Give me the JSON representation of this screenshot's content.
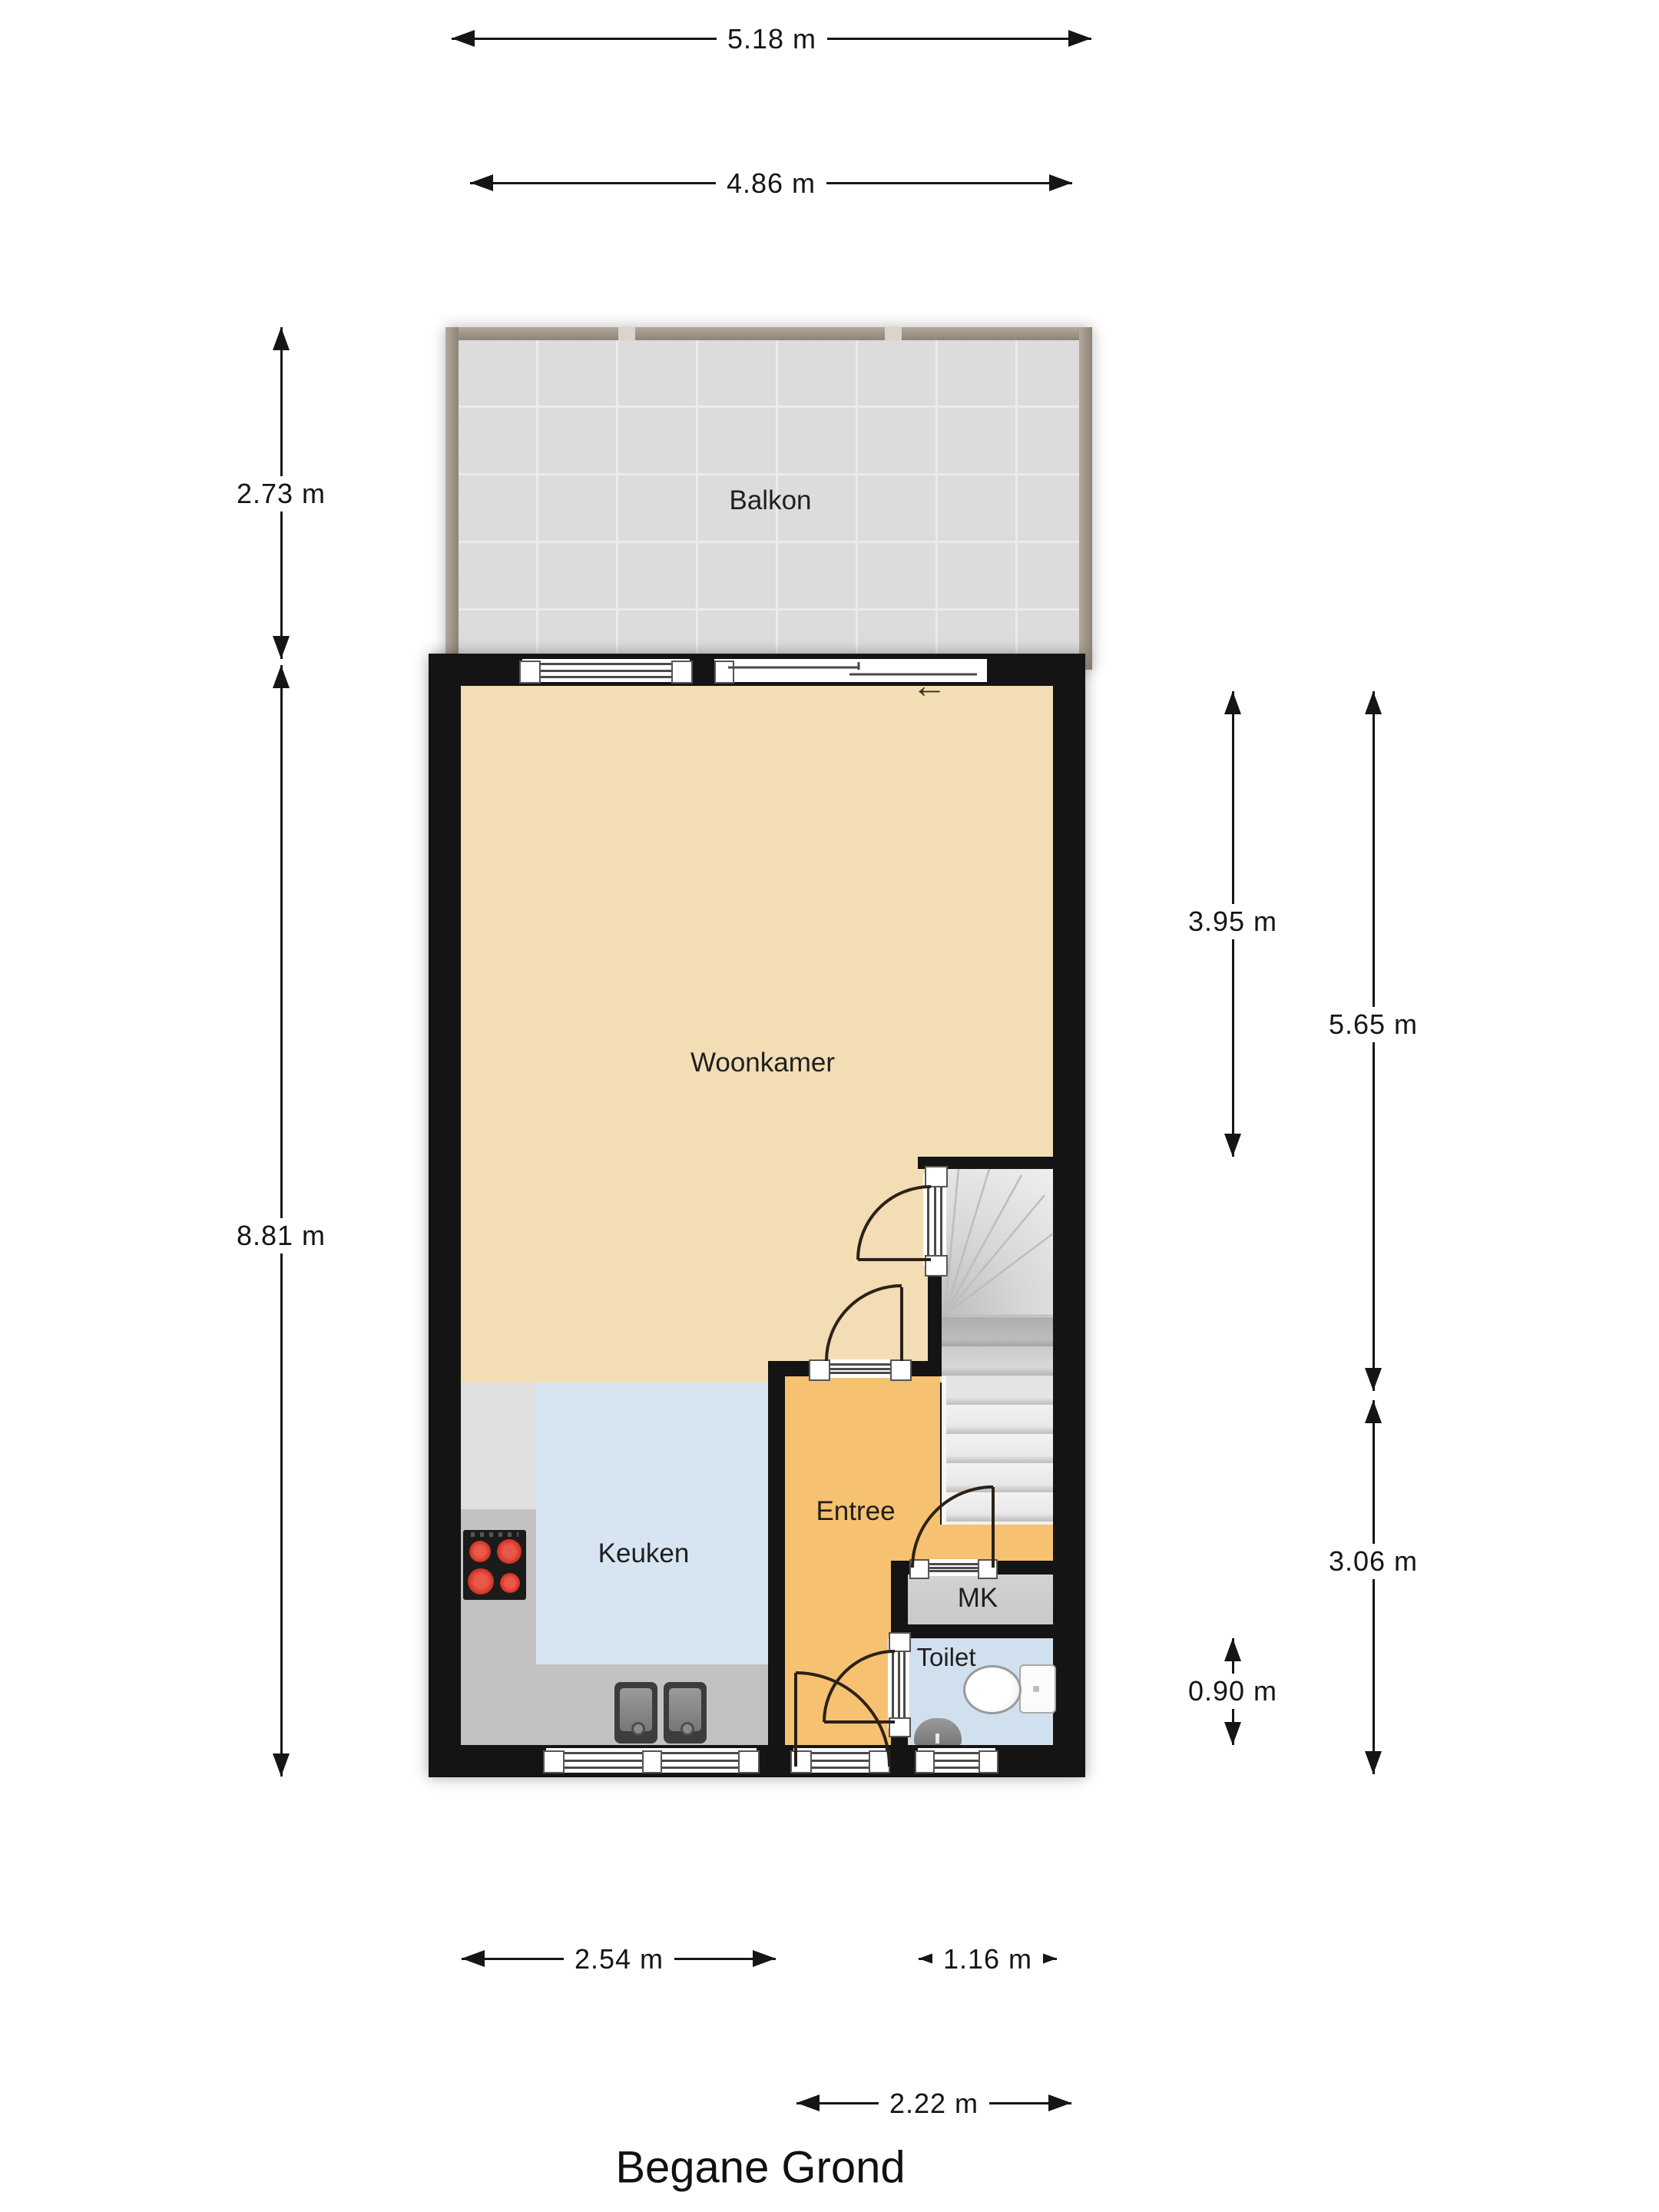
{
  "title": "Begane Grond",
  "rooms": {
    "balkon": {
      "label": "Balkon"
    },
    "woonkamer": {
      "label": "Woonkamer"
    },
    "keuken": {
      "label": "Keuken"
    },
    "entree": {
      "label": "Entree"
    },
    "mk": {
      "label": "MK"
    },
    "toilet": {
      "label": "Toilet"
    }
  },
  "dimensions": {
    "balcony_width": "5.18 m",
    "balcony_inner_width": "4.86 m",
    "balcony_depth": "2.73 m",
    "building_depth": "8.81 m",
    "woonkamer_depth": "3.95 m",
    "living_total_depth": "5.65 m",
    "entree_depth": "3.06 m",
    "toilet_depth": "0.90 m",
    "keuken_width": "2.54 m",
    "toilet_width": "1.16 m",
    "entree_width": "2.22 m"
  },
  "icons": {
    "slide_arrow": "←"
  },
  "colors": {
    "wall": "#141414",
    "woonkamer_floor": "#f2ddb4",
    "keuken_floor": "#d7e5f2",
    "entree_floor": "#f6c170",
    "mk_floor": "#c9c9c9",
    "toilet_floor": "#d0e0ef",
    "balcony_floor": "#dcdcdc",
    "railing": "#a2988c",
    "counter": "#c3c2c1",
    "cabinet": "#e0e0e0",
    "burner": "#d93a2b"
  }
}
